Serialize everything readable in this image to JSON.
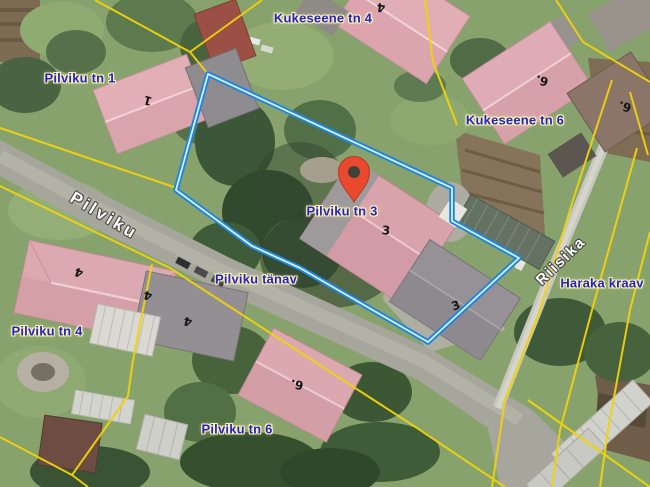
{
  "map": {
    "kind": "aerial cadastral map with selected parcel",
    "address_labels": [
      {
        "id": "kukeseene-tn-4",
        "text": "Kukeseene tn 4"
      },
      {
        "id": "pilviku-tn-1",
        "text": "Pilviku tn 1"
      },
      {
        "id": "kukeseene-tn-6",
        "text": "Kukeseene tn 6"
      },
      {
        "id": "pilviku-tn-3",
        "text": "Pilviku tn 3"
      },
      {
        "id": "pilviku-tanav",
        "text": "Pilviku tänav"
      },
      {
        "id": "pilviku-tn-4",
        "text": "Pilviku tn 4"
      },
      {
        "id": "pilviku-tn-6",
        "text": "Pilviku tn 6"
      },
      {
        "id": "haraka-kraav",
        "text": "Haraka kraav"
      }
    ],
    "street_names": [
      {
        "id": "pilviku",
        "text": "Pilviku"
      },
      {
        "id": "riisika",
        "text": "Riisika"
      }
    ],
    "house_numbers": [
      {
        "text": "4"
      },
      {
        "text": "1"
      },
      {
        "text": "6."
      },
      {
        "text": "6."
      },
      {
        "text": "3"
      },
      {
        "text": "3"
      },
      {
        "text": "4"
      },
      {
        "text": "4"
      },
      {
        "text": "4"
      },
      {
        "text": "6."
      }
    ],
    "marker": {
      "name": "location-pin",
      "points_to": "Pilviku tn 3"
    },
    "colors": {
      "address_label": "#2323cd",
      "address_halo": "#fdf3ae",
      "street_label": "#ffffff",
      "cadastral_line": "#f0d30c",
      "selection_outer": "#1b86de",
      "selection_inner": "#d9edff",
      "marker_red": "#e8492f"
    }
  }
}
